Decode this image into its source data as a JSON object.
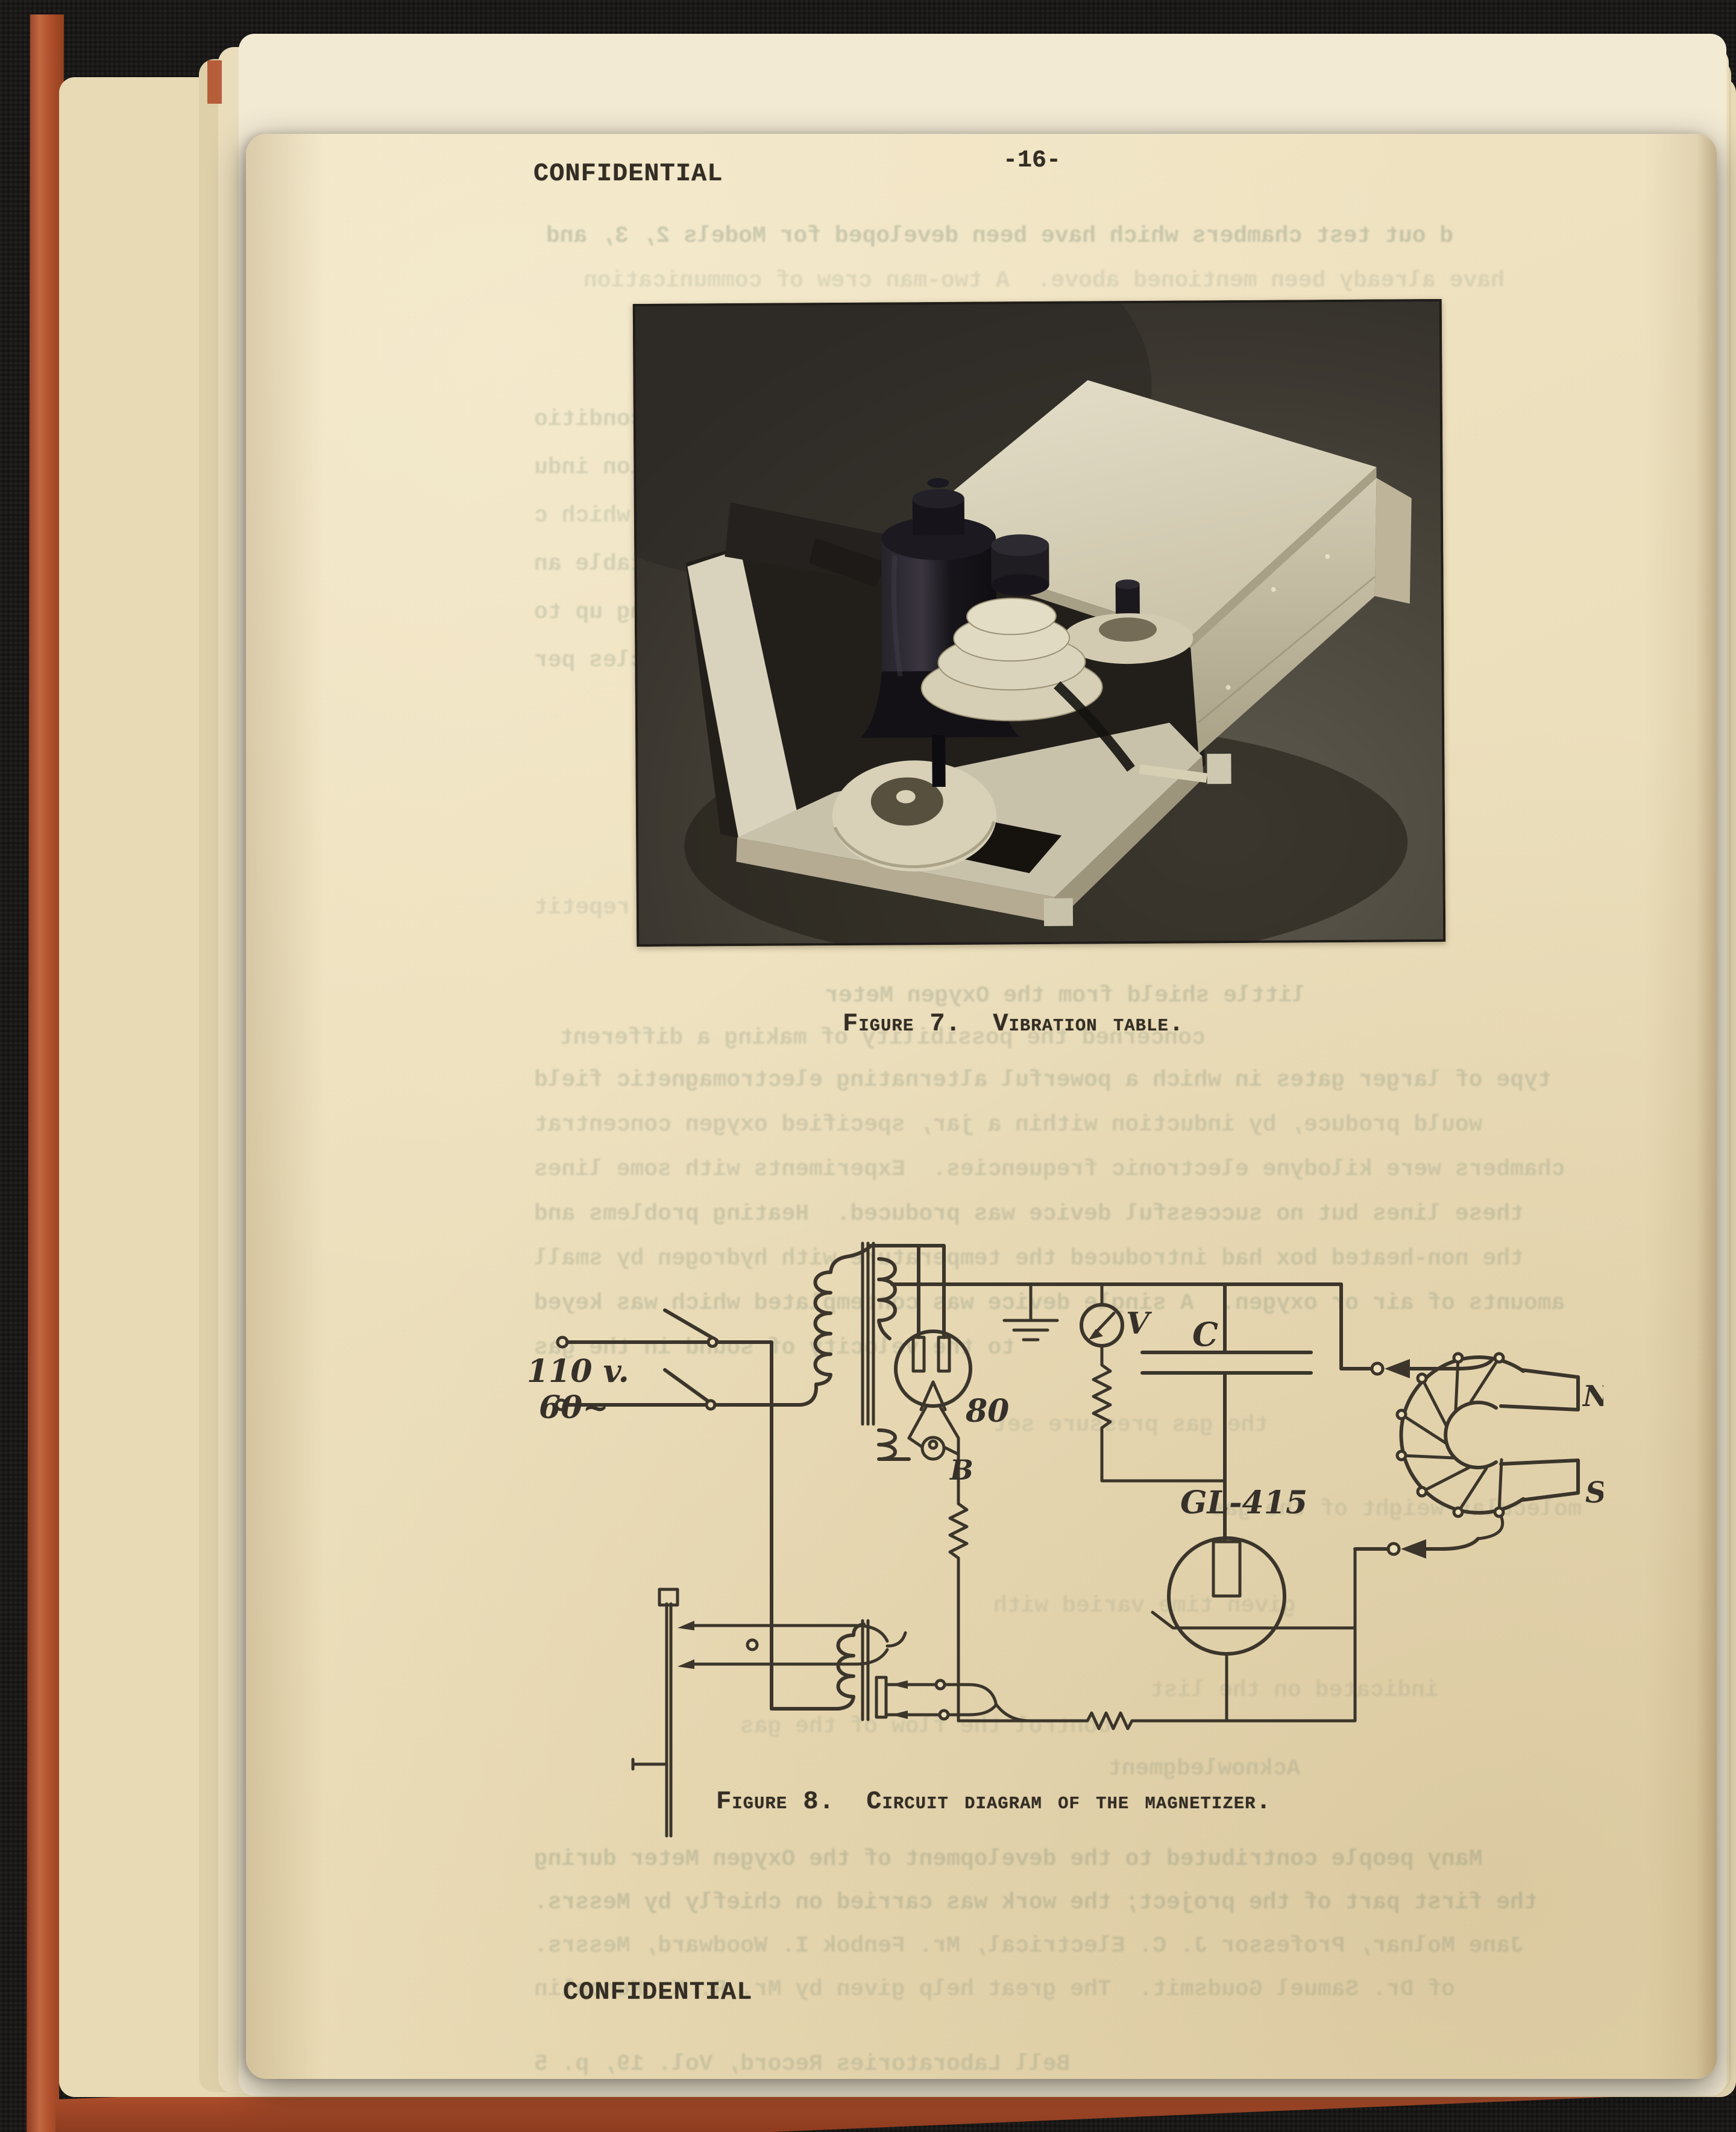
{
  "document": {
    "header": {
      "classification": "CONFIDENTIAL",
      "page_number": "-16-"
    },
    "footer": {
      "classification": "CONFIDENTIAL"
    },
    "figure7": {
      "caption": "Figure 7.  Vibration table."
    },
    "figure8": {
      "caption": "Figure 8.  Circuit diagram of the magnetizer."
    },
    "circuit": {
      "labels": {
        "supply_voltage": "110 v.",
        "supply_frequency": "60~",
        "rectifier_tube": "80",
        "pilot_lamp": "B",
        "voltmeter": "V",
        "capacitor": "C",
        "thyratron_tube": "GL-415",
        "magnet_pole_north": "N",
        "magnet_pole_south": "S"
      }
    },
    "colors": {
      "paper": "#ecdfbc",
      "typed_ink": "#332d24",
      "circuit_ink": "#3b352b",
      "cover_red": "#b1512d",
      "background_black": "#1a1918",
      "photo_background": "#3b3733"
    },
    "bleed_through": {
      "note": "faint mirrored show-through of typed text",
      "lines": [
        [
          498,
          148,
          0.3,
          "d out test chambers which have been developed for Models 2, 3, and"
        ],
        [
          560,
          222,
          0.16,
          "have already been mentioned above.  A two-man crew of communication"
        ],
        [
          478,
          452,
          0.22,
          "under conditio"
        ],
        [
          478,
          532,
          0.22,
          "vibration indu"
        ],
        [
          478,
          612,
          0.2,
          "size, which c"
        ],
        [
          478,
          692,
          0.22,
          "adjustable an"
        ],
        [
          478,
          772,
          0.22,
          "running up to"
        ],
        [
          478,
          852,
          0.22,
          "50 cycles per"
        ],
        [
          478,
          1262,
          0.16,
          "A repetit"
        ],
        [
          960,
          1408,
          0.26,
          "little shield from the Oxygen Meter"
        ],
        [
          520,
          1478,
          0.22,
          "concerned the possibility of making a different"
        ],
        [
          478,
          1548,
          0.24,
          "type of larger gates in which a powerful alternating electromagnetic field"
        ],
        [
          478,
          1622,
          0.22,
          "would produce, by induction within a jar, specified oxygen concentrat"
        ],
        [
          478,
          1696,
          0.22,
          "chambers were kilodyne electronic frequencies.  Experiments with some lines"
        ],
        [
          478,
          1770,
          0.24,
          "these lines but no successful device was produced.  Heating problems and"
        ],
        [
          478,
          1844,
          0.22,
          "the non-heated box had introduced the temperature with hydrogen by small"
        ],
        [
          478,
          1918,
          0.24,
          "amounts of air or oxygen.  A single device was contemplated which was keyed"
        ],
        [
          478,
          1992,
          0.22,
          "to the velocity of sound in the gas"
        ],
        [
          1240,
          2120,
          0.16,
          "the gas pressure set"
        ],
        [
          1600,
          2260,
          0.16,
          "molecular weight of the gas"
        ],
        [
          1240,
          2420,
          0.15,
          "given time varied with"
        ],
        [
          1500,
          2560,
          0.15,
          "indicated on the list"
        ],
        [
          820,
          2620,
          0.15,
          "control the flow of the gas"
        ],
        [
          1430,
          2690,
          0.2,
          "Acknowledgment"
        ],
        [
          478,
          2840,
          0.26,
          "Many people contributed to the development of the Oxygen Meter during"
        ],
        [
          478,
          2912,
          0.26,
          "the first part of the project; the work was carried on chiefly by Messrs."
        ],
        [
          478,
          2984,
          0.22,
          "Jane Molnar, Professor J. C. Electrical, Mr. Fenbok I. Woodward, Messrs."
        ],
        [
          478,
          3056,
          0.2,
          "of Dr. Samuel Goudsmit.  The great help given by Mr. R. K. Kenoplin"
        ],
        [
          478,
          3180,
          0.22,
          "Bell Laboratories Record, Vol. 19, p. 5"
        ]
      ]
    }
  }
}
